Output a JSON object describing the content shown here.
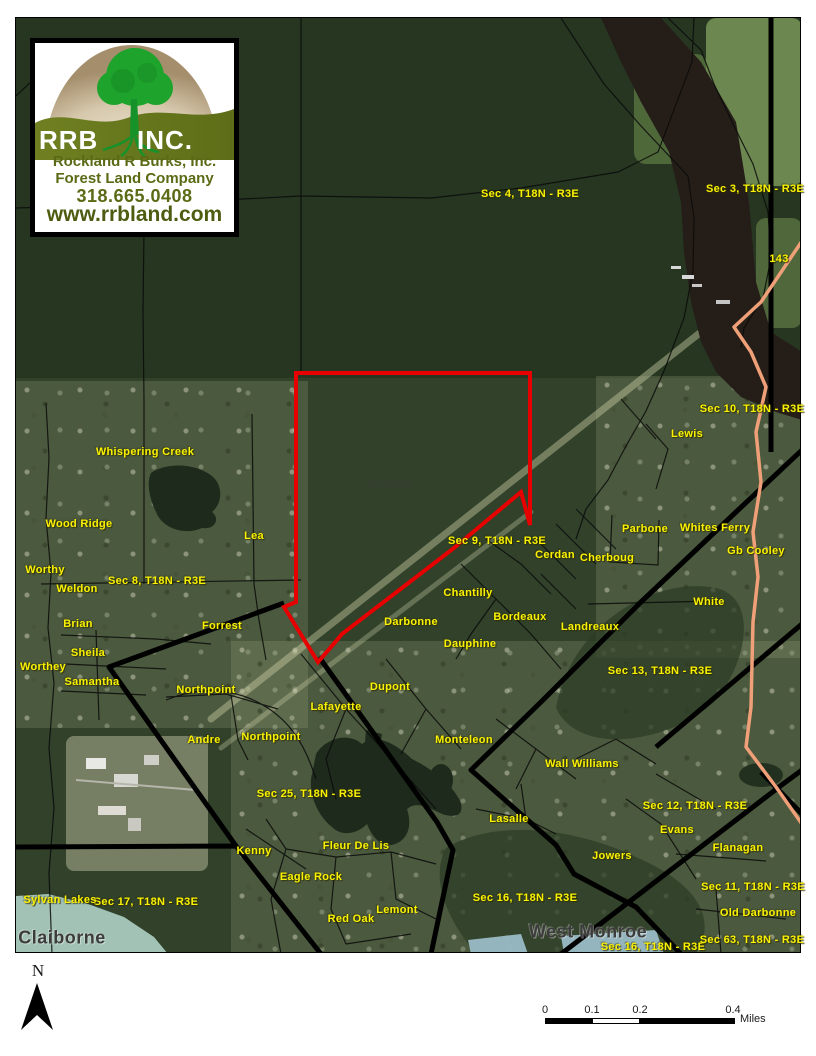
{
  "logo": {
    "abbr_left": "RRB",
    "abbr_right": "INC.",
    "line1": "Rockland R Burks, Inc.",
    "line2": "Forest Land Company",
    "phone": "318.665.0408",
    "website": "www.rrbland.com"
  },
  "labels": {
    "sections": [
      {
        "text": "Sec 4,  T18N - R3E",
        "x": 530,
        "y": 194
      },
      {
        "text": "Sec 3,  T18N - R3E",
        "x": 755,
        "y": 189
      },
      {
        "text": "Sec 10,  T18N - R3E",
        "x": 752,
        "y": 409
      },
      {
        "text": "Sec 9,  T18N - R3E",
        "x": 497,
        "y": 541
      },
      {
        "text": "Sec 8,  T18N - R3E",
        "x": 157,
        "y": 581
      },
      {
        "text": "Sec 13,  T18N - R3E",
        "x": 660,
        "y": 671
      },
      {
        "text": "Sec 25,  T18N - R3E",
        "x": 309,
        "y": 794
      },
      {
        "text": "Sec 12,  T18N - R3E",
        "x": 695,
        "y": 806
      },
      {
        "text": "Sec 11,  T18N - R3E",
        "x": 753,
        "y": 887
      },
      {
        "text": "Sec 17,  T18N - R3E",
        "x": 146,
        "y": 902
      },
      {
        "text": "Sec 16,  T18N - R3E",
        "x": 525,
        "y": 898
      },
      {
        "text": "Sec 16,  T18N - R3E",
        "x": 653,
        "y": 947
      },
      {
        "text": "Sec 63,  T18N - R3E",
        "x": 752,
        "y": 940
      }
    ],
    "places": [
      {
        "text": "Whispering Creek",
        "x": 145,
        "y": 452
      },
      {
        "text": "Wood Ridge",
        "x": 79,
        "y": 524
      },
      {
        "text": "Lea",
        "x": 254,
        "y": 536
      },
      {
        "text": "Worthy",
        "x": 45,
        "y": 570
      },
      {
        "text": "Weldon",
        "x": 77,
        "y": 589
      },
      {
        "text": "Brian",
        "x": 78,
        "y": 624
      },
      {
        "text": "Forrest",
        "x": 222,
        "y": 626
      },
      {
        "text": "Sheila",
        "x": 88,
        "y": 653
      },
      {
        "text": "Worthey",
        "x": 43,
        "y": 667
      },
      {
        "text": "Samantha",
        "x": 92,
        "y": 682
      },
      {
        "text": "Northpoint",
        "x": 206,
        "y": 690
      },
      {
        "text": "Northpoint",
        "x": 271,
        "y": 737
      },
      {
        "text": "Andre",
        "x": 204,
        "y": 740
      },
      {
        "text": "Lafayette",
        "x": 336,
        "y": 707
      },
      {
        "text": "Dupont",
        "x": 390,
        "y": 687
      },
      {
        "text": "Darbonne",
        "x": 411,
        "y": 622
      },
      {
        "text": "Chantilly",
        "x": 468,
        "y": 593
      },
      {
        "text": "Dauphine",
        "x": 470,
        "y": 644
      },
      {
        "text": "Bordeaux",
        "x": 520,
        "y": 617
      },
      {
        "text": "Monteleon",
        "x": 464,
        "y": 740
      },
      {
        "text": "Cerdan",
        "x": 555,
        "y": 555
      },
      {
        "text": "Cherboug",
        "x": 607,
        "y": 558
      },
      {
        "text": "Landreaux",
        "x": 590,
        "y": 627
      },
      {
        "text": "White",
        "x": 709,
        "y": 602
      },
      {
        "text": "Parbone",
        "x": 645,
        "y": 529
      },
      {
        "text": "Whites Ferry",
        "x": 715,
        "y": 528
      },
      {
        "text": "Gb Cooley",
        "x": 756,
        "y": 551
      },
      {
        "text": "Lewis",
        "x": 687,
        "y": 434
      },
      {
        "text": "Wall Williams",
        "x": 582,
        "y": 764
      },
      {
        "text": "Evans",
        "x": 677,
        "y": 830
      },
      {
        "text": "Flanagan",
        "x": 738,
        "y": 848
      },
      {
        "text": "Jowers",
        "x": 612,
        "y": 856
      },
      {
        "text": "Old Darbonne",
        "x": 758,
        "y": 913
      },
      {
        "text": "Lasalle",
        "x": 509,
        "y": 819
      },
      {
        "text": "Kenny",
        "x": 254,
        "y": 851
      },
      {
        "text": "Eagle Rock",
        "x": 311,
        "y": 877
      },
      {
        "text": "Fleur De Lis",
        "x": 356,
        "y": 846
      },
      {
        "text": "Red Oak",
        "x": 351,
        "y": 919
      },
      {
        "text": "Lemont",
        "x": 397,
        "y": 910
      },
      {
        "text": "Sylvan Lakes",
        "x": 60,
        "y": 900
      }
    ],
    "cities": [
      {
        "text": "Claiborne",
        "x": 62,
        "y": 938
      },
      {
        "text": "West Monroe",
        "x": 588,
        "y": 932
      }
    ],
    "areas": [
      {
        "text": "Ouachita",
        "x": 390,
        "y": 484
      }
    ],
    "road_shields": [
      {
        "text": "143",
        "x": 779,
        "y": 259
      }
    ]
  },
  "north_arrow": {
    "label": "N"
  },
  "scale_bar": {
    "ticks": [
      {
        "label": "0",
        "x": 5
      },
      {
        "label": "0.1",
        "x": 52
      },
      {
        "label": "0.2",
        "x": 100
      },
      {
        "label": "0.4",
        "x": 193
      }
    ],
    "unit": "Miles"
  },
  "colors": {
    "label_yellow": "#FAF202",
    "boundary_red": "#E60000",
    "city_gray": "#3C3C3C",
    "highway_orange": "#F0A078",
    "water_dark": "#251E18",
    "logo_olive": "#5A6A15"
  }
}
